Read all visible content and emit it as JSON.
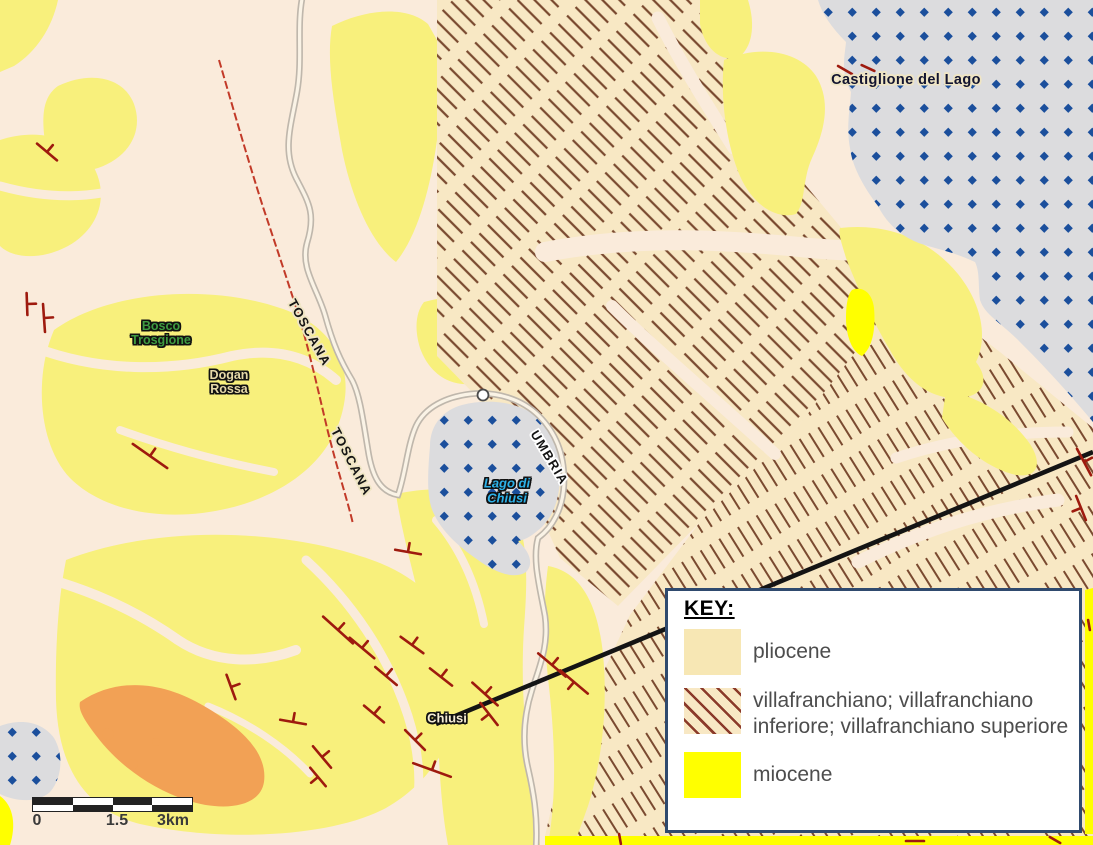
{
  "map": {
    "labels": {
      "castiglione_del_lago": "Castiglione del Lago",
      "bosco_trosgione": "Bosco\nTrosgione",
      "dogan_rossa": "Dogan\nRossa",
      "toscana_upper": "TOSCANA",
      "toscana_lower": "TOSCANA",
      "umbria": "UMBRIA",
      "lago_di_chiusi": "Lago di\nChiusi",
      "chiusi": "Chiusi"
    },
    "scale_bar": {
      "tick_start": "0",
      "tick_mid": "1.5",
      "tick_end": "3km"
    },
    "strike_dip_symbols": [
      [
        47,
        152,
        40,
        26,
        1
      ],
      [
        27,
        304,
        88,
        22,
        1
      ],
      [
        44,
        318,
        86,
        28,
        1
      ],
      [
        150,
        456,
        35,
        42,
        1
      ],
      [
        231,
        687,
        70,
        26,
        1
      ],
      [
        293,
        722,
        10,
        26,
        1
      ],
      [
        338,
        630,
        42,
        40,
        1
      ],
      [
        362,
        648,
        40,
        32,
        1
      ],
      [
        412,
        645,
        36,
        28,
        1
      ],
      [
        386,
        676,
        40,
        28,
        1
      ],
      [
        441,
        677,
        38,
        28,
        1
      ],
      [
        408,
        552,
        10,
        26,
        1
      ],
      [
        485,
        694,
        42,
        34,
        1
      ],
      [
        489,
        714,
        52,
        28,
        -1
      ],
      [
        374,
        714,
        40,
        26,
        1
      ],
      [
        415,
        740,
        45,
        28,
        1
      ],
      [
        322,
        757,
        50,
        28,
        1
      ],
      [
        318,
        777,
        50,
        24,
        -1
      ],
      [
        432,
        770,
        20,
        40,
        1
      ],
      [
        552,
        665,
        40,
        36,
        1
      ],
      [
        574,
        682,
        40,
        36,
        -1
      ],
      [
        845,
        70,
        30,
        16,
        0
      ],
      [
        868,
        68,
        25,
        14,
        0
      ],
      [
        1084,
        462,
        62,
        30,
        1
      ],
      [
        1081,
        508,
        68,
        26,
        -1
      ],
      [
        620,
        839,
        80,
        10,
        0
      ],
      [
        915,
        841,
        0,
        18,
        0
      ],
      [
        1055,
        840,
        30,
        12,
        0
      ],
      [
        1089,
        625,
        80,
        10,
        0
      ]
    ]
  },
  "key": {
    "title": "KEY:",
    "entries": [
      {
        "swatch": "pliocene-swatch",
        "label": "pliocene"
      },
      {
        "swatch": "villafranchiano-swatch",
        "label": "villafranchiano; villafranchiano inferiore; villafranchiano superiore"
      },
      {
        "swatch": "miocene-swatch",
        "label": "miocene"
      }
    ]
  },
  "palette": {
    "background_cream": "#faebdb",
    "pliocene_yellow": "#f8f07c",
    "pliocene_key_swatch": "#f7e7b4",
    "villafranchiano_tan": "#f8e8c4",
    "hatch_line": "#7a4a30",
    "key_hatch_line": "#8b3a2a",
    "miocene_yellow": "#ffff00",
    "orange_unit": "#f2a155",
    "lake_gray": "#dcdcde",
    "lake_dot_blue": "#1b4f9c",
    "road_casing": "#bfb7ac",
    "road_fill": "#faf3e6",
    "region_boundary_red": "#c23a28",
    "railway_black": "#141414",
    "fault_red": "#9e1a0e",
    "key_border_navy": "#2f4a6e",
    "key_text_gray": "#4d4d4d"
  }
}
